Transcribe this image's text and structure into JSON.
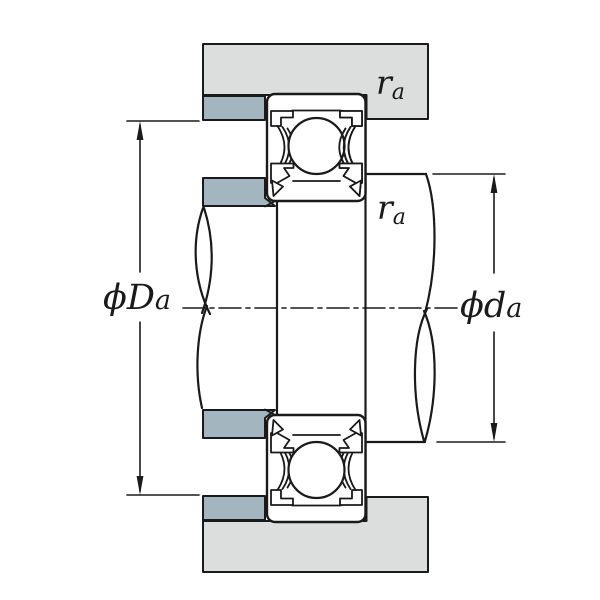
{
  "figure": {
    "description": "Technical cross-section drawing of a sealed deep-groove ball bearing mounted between housing and shaft abutments, with abutment diameter and fillet radius dimensions",
    "type": "engineering-dimension-diagram"
  },
  "labels": {
    "housing_abutment_diameter": {
      "prefix": "ϕD",
      "sub": "a"
    },
    "shaft_abutment_diameter": {
      "prefix": "ϕd",
      "sub": "a"
    },
    "fillet_radius_housing": {
      "main": "r",
      "sub": "a"
    },
    "fillet_radius_shaft": {
      "main": "r",
      "sub": "a"
    }
  },
  "colors": {
    "background": "#ffffff",
    "housing_gray": "#dcdddd",
    "abutment_blue": "#a3b5be",
    "line": "#1a1a1a",
    "part_fill": "#ffffff"
  },
  "parts": {
    "housing": "housing-section",
    "abutment_rings": "abutment-shoulder-rings",
    "bearing": "sealed-ball-bearing-section",
    "shaft": "stepped-shaft-with-breaks",
    "centerline": "axis-centerline"
  }
}
